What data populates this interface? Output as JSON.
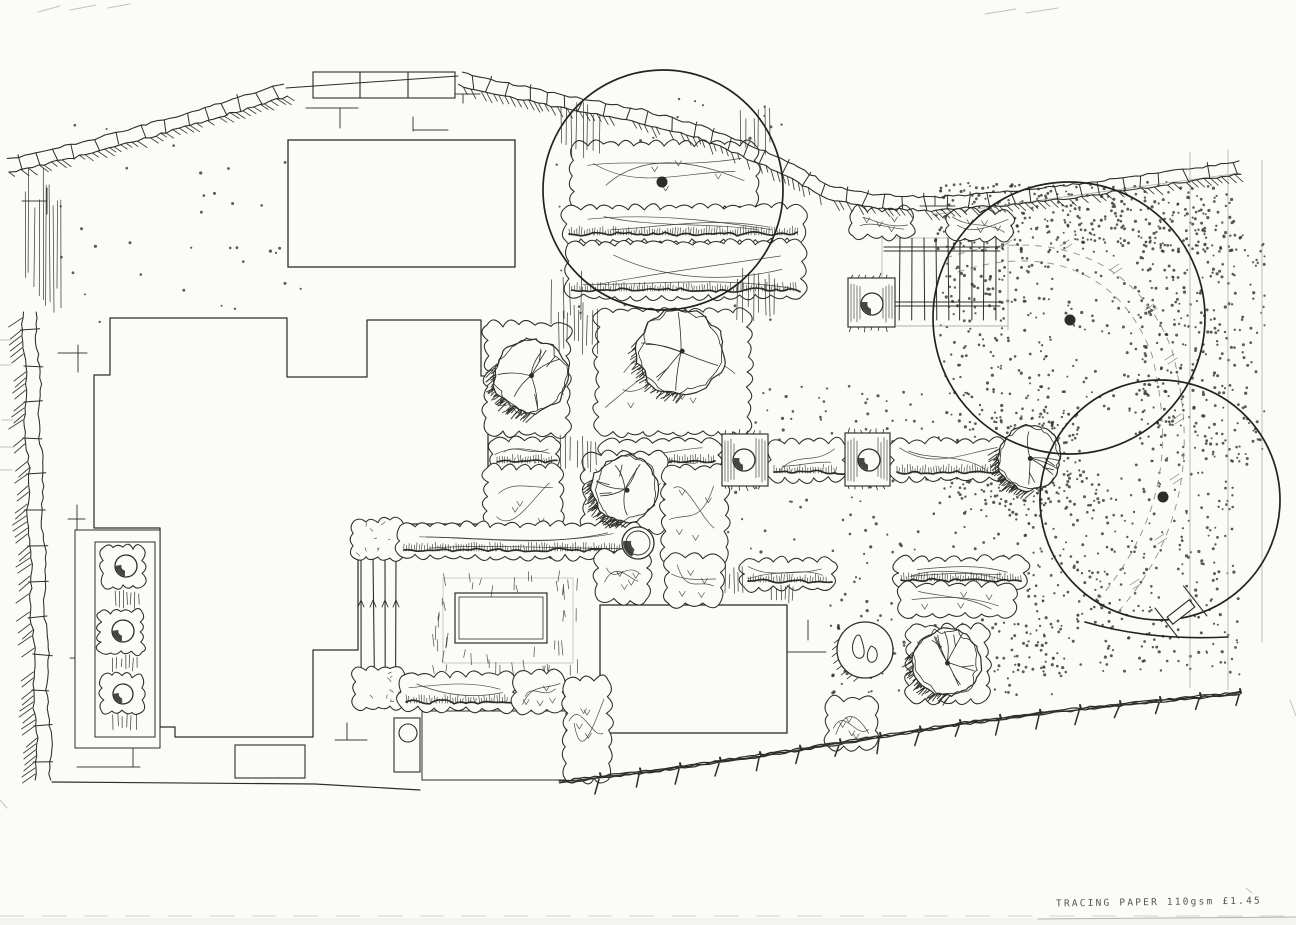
{
  "caption": {
    "text": "TRACING PAPER 110gsm £1.45"
  },
  "plan": {
    "canvas": {
      "w": 1296,
      "h": 925,
      "bg": "#fbfbf8",
      "ink": "#2e2c29",
      "faint": "#aeaca7",
      "dot": "#35322e"
    },
    "wall_segments": [
      {
        "stones": true,
        "pts": [
          [
            8,
            166
          ],
          [
            90,
            147
          ],
          [
            200,
            116
          ],
          [
            286,
            90
          ]
        ]
      },
      {
        "stones": false,
        "pts": [
          [
            286,
            88
          ],
          [
            458,
            76
          ]
        ]
      },
      {
        "stones": true,
        "pts": [
          [
            460,
            79
          ],
          [
            512,
            91
          ],
          [
            575,
            104
          ],
          [
            640,
            116
          ],
          [
            700,
            132
          ],
          [
            745,
            150
          ],
          [
            790,
            170
          ],
          [
            828,
            192
          ],
          [
            872,
            201
          ],
          [
            930,
            204
          ],
          [
            1000,
            199
          ],
          [
            1080,
            190
          ],
          [
            1160,
            179
          ],
          [
            1240,
            168
          ]
        ]
      }
    ],
    "drive_strip": {
      "x": 313,
      "y": 72,
      "w": 142,
      "h": 26,
      "dividers": [
        360,
        408
      ]
    },
    "left_fence": {
      "top": [
        30,
        312
      ],
      "bottom": [
        44,
        780
      ]
    },
    "bottom_fence": [
      [
        560,
        782
      ],
      [
        660,
        770
      ],
      [
        760,
        756
      ],
      [
        860,
        740
      ],
      [
        960,
        724
      ],
      [
        1060,
        711
      ],
      [
        1160,
        701
      ],
      [
        1240,
        693
      ]
    ],
    "bottom_line": [
      [
        52,
        782
      ],
      [
        315,
        784
      ],
      [
        420,
        790
      ]
    ],
    "house_path": "M94,375 L110,375 L110,318 L287,318 L287,377 L367,377 L367,320 L481,320 L481,376 L488,376 L488,524 L358,524 L358,650 L313,650 L313,737 L175,737 L175,727 L160,727 L160,528 L94,528 Z",
    "rects": [
      {
        "name": "garage",
        "x": 288,
        "y": 140,
        "w": 227,
        "h": 127,
        "sw": 1.3
      },
      {
        "name": "outbuilding",
        "x": 600,
        "y": 605,
        "w": 187,
        "h": 128,
        "sw": 1.3
      },
      {
        "name": "lower-patio",
        "x": 422,
        "y": 711,
        "w": 144,
        "h": 69,
        "sw": 1
      },
      {
        "name": "door-step",
        "x": 235,
        "y": 745,
        "w": 70,
        "h": 33,
        "sw": 1.1
      },
      {
        "name": "terrace-outer",
        "x": 75,
        "y": 530,
        "w": 85,
        "h": 218,
        "sw": 1
      },
      {
        "name": "terrace-inner",
        "x": 95,
        "y": 542,
        "w": 60,
        "h": 195,
        "sw": 1
      }
    ],
    "water_butt": {
      "x": 394,
      "y": 718,
      "w": 26,
      "h": 54,
      "cx": 408,
      "cy": 733,
      "r": 9
    },
    "deck": {
      "vxs": [
        900,
        912,
        924,
        936,
        948,
        960,
        972,
        984,
        996
      ],
      "vy1": 238,
      "vy2": 320,
      "hpairs": [
        [
          247,
          251
        ],
        [
          302,
          306
        ]
      ],
      "hx1": 884,
      "hx2": 1000,
      "frame": [
        882,
        238,
        126,
        88
      ]
    },
    "deck_planter": {
      "x": 848,
      "y": 278,
      "w": 47,
      "h": 49,
      "cx": 872,
      "cy": 304,
      "r": 11
    },
    "row_planters": [
      {
        "x": 722,
        "y": 434,
        "w": 46,
        "h": 52,
        "cx": 744,
        "cy": 460,
        "r": 11
      },
      {
        "x": 845,
        "y": 433,
        "w": 45,
        "h": 53,
        "cx": 869,
        "cy": 460,
        "r": 11
      }
    ],
    "terrace_planters": [
      {
        "x": 103,
        "y": 548,
        "w": 40,
        "h": 38,
        "cx": 126,
        "cy": 566,
        "r": 11
      },
      {
        "x": 100,
        "y": 612,
        "w": 42,
        "h": 40,
        "cx": 123,
        "cy": 631,
        "r": 11
      },
      {
        "x": 102,
        "y": 676,
        "w": 40,
        "h": 36,
        "cx": 123,
        "cy": 694,
        "r": 10
      }
    ],
    "pergola": {
      "xs": [
        361,
        373,
        385,
        396
      ],
      "y1": 556,
      "y2": 676,
      "arrow_y": 602,
      "squares": [
        [
          354,
          521,
          48,
          37
        ],
        [
          354,
          669,
          48,
          38
        ]
      ]
    },
    "lawn": {
      "outer": [
        443,
        578,
        130,
        85
      ],
      "inner": [
        455,
        593,
        92,
        50
      ],
      "tick_zone": [
        432,
        570,
        146,
        98
      ]
    },
    "beds": [
      {
        "x": 573,
        "y": 145,
        "w": 182,
        "h": 62,
        "kind": "scallop"
      },
      {
        "x": 565,
        "y": 208,
        "w": 238,
        "h": 32,
        "kind": "band"
      },
      {
        "x": 568,
        "y": 244,
        "w": 234,
        "h": 52,
        "kind": "band"
      },
      {
        "x": 487,
        "y": 325,
        "w": 80,
        "h": 108,
        "kind": "scallop"
      },
      {
        "x": 598,
        "y": 312,
        "w": 150,
        "h": 120,
        "kind": "scallop"
      },
      {
        "x": 493,
        "y": 440,
        "w": 63,
        "h": 28,
        "kind": "band"
      },
      {
        "x": 603,
        "y": 442,
        "w": 115,
        "h": 26,
        "kind": "band"
      },
      {
        "x": 487,
        "y": 468,
        "w": 73,
        "h": 86,
        "kind": "scallop"
      },
      {
        "x": 585,
        "y": 455,
        "w": 80,
        "h": 74,
        "kind": "scallop"
      },
      {
        "x": 665,
        "y": 468,
        "w": 60,
        "h": 95,
        "kind": "scallop"
      },
      {
        "x": 400,
        "y": 526,
        "w": 240,
        "h": 30,
        "kind": "band"
      },
      {
        "x": 598,
        "y": 552,
        "w": 48,
        "h": 48,
        "kind": "scallop"
      },
      {
        "x": 402,
        "y": 676,
        "w": 112,
        "h": 32,
        "kind": "band"
      },
      {
        "x": 516,
        "y": 674,
        "w": 46,
        "h": 36,
        "kind": "scallop"
      },
      {
        "x": 566,
        "y": 680,
        "w": 42,
        "h": 100,
        "kind": "scallop"
      },
      {
        "x": 668,
        "y": 557,
        "w": 52,
        "h": 46,
        "kind": "scallop"
      },
      {
        "x": 744,
        "y": 561,
        "w": 88,
        "h": 26,
        "kind": "band"
      },
      {
        "x": 897,
        "y": 560,
        "w": 128,
        "h": 26,
        "kind": "band"
      },
      {
        "x": 900,
        "y": 586,
        "w": 114,
        "h": 28,
        "kind": "scallop"
      },
      {
        "x": 770,
        "y": 442,
        "w": 73,
        "h": 36,
        "kind": "band"
      },
      {
        "x": 893,
        "y": 442,
        "w": 112,
        "h": 36,
        "kind": "band"
      },
      {
        "x": 910,
        "y": 628,
        "w": 76,
        "h": 72,
        "kind": "scallop"
      },
      {
        "x": 828,
        "y": 700,
        "w": 47,
        "h": 46,
        "kind": "scallop"
      },
      {
        "x": 853,
        "y": 210,
        "w": 58,
        "h": 26,
        "kind": "scallop"
      },
      {
        "x": 950,
        "y": 213,
        "w": 60,
        "h": 25,
        "kind": "scallop"
      }
    ],
    "vstrips": [
      [
        22,
        168,
        40,
        148,
        3.5
      ],
      [
        556,
        98,
        44,
        64,
        5
      ],
      [
        548,
        266,
        34,
        58,
        5
      ],
      [
        737,
        102,
        36,
        56,
        5
      ],
      [
        737,
        266,
        38,
        58,
        5
      ],
      [
        555,
        300,
        44,
        56,
        5
      ],
      [
        560,
        432,
        36,
        40,
        4
      ],
      [
        722,
        565,
        22,
        32,
        4
      ],
      [
        768,
        583,
        28,
        20,
        4
      ],
      [
        112,
        590,
        28,
        20,
        4
      ],
      [
        112,
        654,
        28,
        18,
        4
      ],
      [
        108,
        710,
        30,
        22,
        4
      ]
    ],
    "trees_big": [
      {
        "cx": 663,
        "cy": 190,
        "r": 120
      },
      {
        "cx": 1069,
        "cy": 318,
        "r": 136
      },
      {
        "cx": 1160,
        "cy": 500,
        "r": 120
      }
    ],
    "trunk_dots": [
      [
        662,
        182,
        5
      ],
      [
        1070,
        320,
        5
      ],
      [
        1163,
        497,
        5
      ]
    ],
    "trees_medium": [
      {
        "cx": 531,
        "cy": 376,
        "r": 37
      },
      {
        "cx": 681,
        "cy": 352,
        "r": 43
      },
      {
        "cx": 625,
        "cy": 489,
        "r": 33
      },
      {
        "cx": 1030,
        "cy": 458,
        "r": 32
      },
      {
        "cx": 947,
        "cy": 662,
        "r": 34
      }
    ],
    "pot_feature": {
      "cx": 638,
      "cy": 543,
      "r": 16
    },
    "boulder": {
      "cx": 865,
      "cy": 650,
      "r": 28
    },
    "gravel_regions": [
      [
        935,
        182,
        300,
        70,
        380
      ],
      [
        938,
        255,
        115,
        250,
        260
      ],
      [
        1135,
        235,
        130,
        230,
        330
      ],
      [
        955,
        470,
        285,
        205,
        430
      ],
      [
        1060,
        255,
        95,
        160,
        60
      ],
      [
        700,
        385,
        240,
        170,
        110
      ],
      [
        828,
        545,
        235,
        150,
        150
      ],
      [
        60,
        125,
        250,
        200,
        35
      ],
      [
        552,
        95,
        235,
        230,
        60
      ],
      [
        990,
        410,
        90,
        95,
        130
      ]
    ],
    "gravel_paths": [
      "M946,258 C1040,226 1135,252 1172,350 C1195,440 1190,530 1118,612",
      "M958,272 C1042,244 1120,268 1152,355 C1172,440 1168,515 1100,598"
    ],
    "path_slashes": [
      [
        1000,
        242
      ],
      [
        1060,
        246
      ],
      [
        1110,
        270
      ],
      [
        1145,
        310
      ],
      [
        1165,
        360
      ],
      [
        1172,
        420
      ],
      [
        1170,
        480
      ],
      [
        1155,
        540
      ],
      [
        1130,
        585
      ]
    ],
    "faint_lines": [
      [
        1190,
        152,
        1190,
        688
      ],
      [
        1228,
        150,
        1228,
        690
      ],
      [
        1262,
        160,
        1262,
        642
      ],
      [
        932,
        215,
        1240,
        173
      ],
      [
        897,
        326,
        1008,
        326
      ],
      [
        1008,
        238,
        1008,
        330
      ]
    ],
    "tmarks": [
      [
        306,
        108,
        358,
        108
      ],
      [
        340,
        108,
        340,
        128
      ],
      [
        453,
        94,
        480,
        94
      ],
      [
        463,
        94,
        463,
        103
      ],
      [
        413,
        117,
        413,
        131
      ],
      [
        413,
        130,
        448,
        130
      ],
      [
        47,
        188,
        47,
        214
      ],
      [
        22,
        201,
        47,
        201
      ],
      [
        920,
        206,
        955,
        206
      ],
      [
        935,
        196,
        935,
        206
      ],
      [
        58,
        353,
        87,
        353
      ],
      [
        78,
        345,
        78,
        372
      ],
      [
        68,
        519,
        85,
        519
      ],
      [
        77,
        505,
        77,
        533
      ],
      [
        70,
        658,
        88,
        658
      ],
      [
        79,
        645,
        79,
        673
      ],
      [
        77,
        767,
        140,
        767
      ],
      [
        133,
        744,
        133,
        767
      ],
      [
        335,
        740,
        367,
        740
      ],
      [
        347,
        723,
        347,
        740
      ],
      [
        808,
        620,
        808,
        640
      ],
      [
        788,
        652,
        826,
        652
      ]
    ],
    "bench": {
      "cx": 1181,
      "cy": 612,
      "angle": -38,
      "w": 28,
      "h": 9,
      "arm_half": 19,
      "arm_off": 18
    },
    "bottom_curve": "M1085,622 Q1150,641 1228,637",
    "edge_artifacts": [
      [
        38,
        12,
        60,
        6
      ],
      [
        70,
        10,
        96,
        5
      ],
      [
        108,
        8,
        130,
        4
      ],
      [
        985,
        14,
        1016,
        9
      ],
      [
        1026,
        13,
        1058,
        8
      ],
      [
        1290,
        700,
        1296,
        716
      ],
      [
        0,
        800,
        7,
        808
      ],
      [
        1246,
        888,
        1252,
        893
      ],
      [
        0,
        447,
        14,
        447
      ],
      [
        0,
        470,
        12,
        470
      ],
      [
        2,
        420,
        13,
        420
      ],
      [
        0,
        340,
        10,
        340
      ],
      [
        0,
        365,
        11,
        365
      ]
    ],
    "paper_edge": {
      "dash_y": 916,
      "solid": [
        1038,
        919,
        1296,
        917
      ]
    }
  }
}
